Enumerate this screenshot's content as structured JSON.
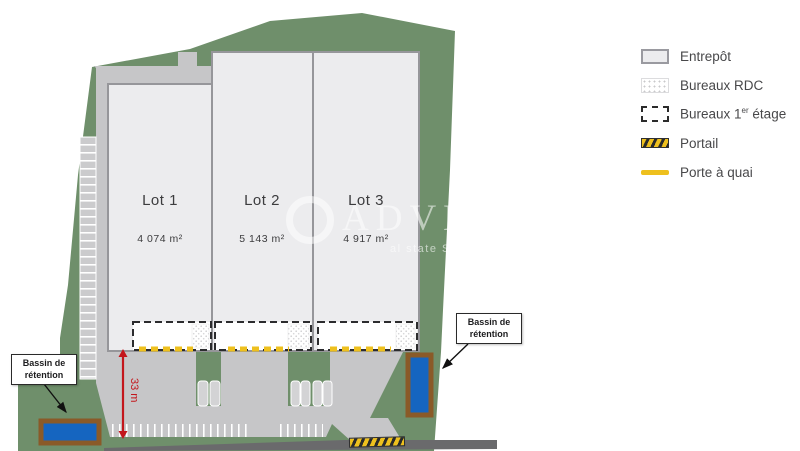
{
  "colors": {
    "site_green": "#6f8f6b",
    "yard_gray": "#c6c6c8",
    "building_fill": "#ececee",
    "building_border": "#96969a",
    "road_gray": "#6a6a6c",
    "basin_blue": "#1565c0",
    "basin_brown": "#8a5a28",
    "dock_yellow": "#eec01e",
    "dim_red": "#c3161c",
    "text_dark": "#3c3c3e"
  },
  "plan": {
    "lots": [
      {
        "name": "Lot 1",
        "area": "4 074 m²"
      },
      {
        "name": "Lot 2",
        "area": "5 143 m²"
      },
      {
        "name": "Lot 3",
        "area": "4 917 m²"
      }
    ],
    "dimension_label": "33 m",
    "basin_label": {
      "line1": "Bassin de",
      "line2": "rétention"
    }
  },
  "legend": {
    "items": [
      {
        "label": "Entrepôt"
      },
      {
        "label": "Bureaux RDC"
      },
      {
        "prefix": "Bureaux 1",
        "sup": "er",
        "suffix": " étage"
      },
      {
        "label": "Portail"
      },
      {
        "label": "Porte à quai"
      }
    ]
  },
  "watermark": {
    "text_large": "ADVEN",
    "text_small": "al state So"
  }
}
